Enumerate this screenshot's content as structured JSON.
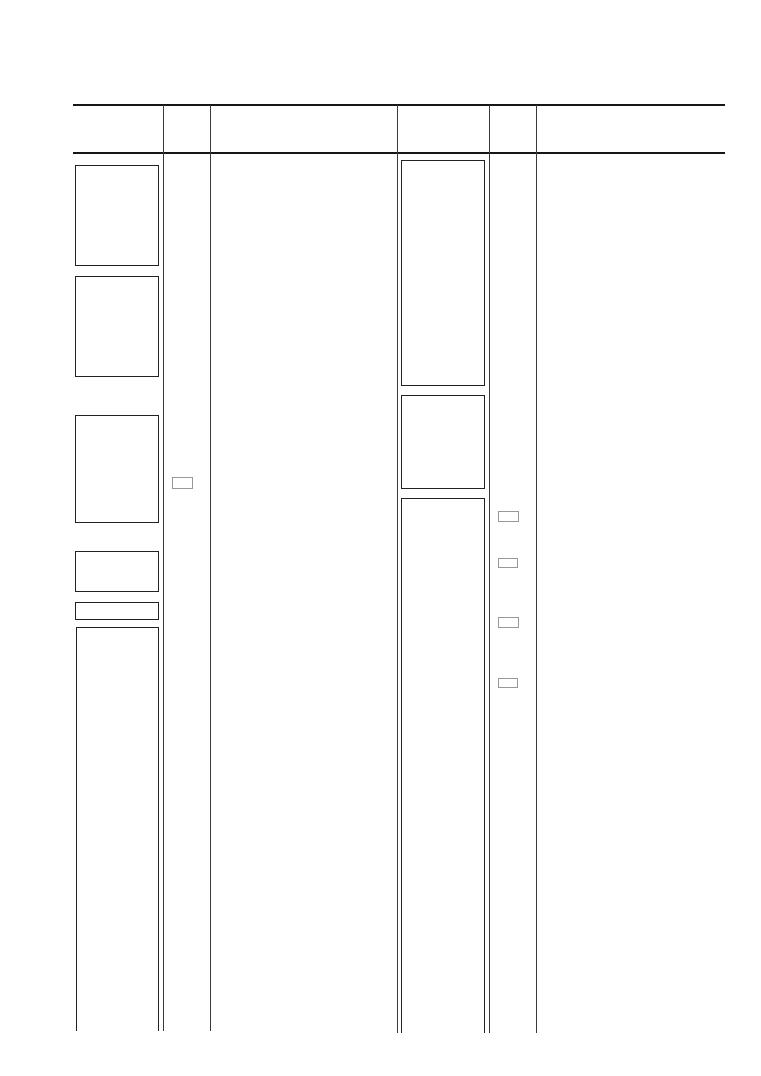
{
  "page": {
    "width": 761,
    "height": 1076,
    "background": "#ffffff",
    "visible_text": ""
  },
  "colors": {
    "header_rule": "#161616",
    "column_divider": "#3a3a3a",
    "box_border": "#222222",
    "placeholder_border": "#989898"
  },
  "table": {
    "header_rules": [
      {
        "name": "header-top-rule",
        "x": 73,
        "y": 104,
        "width": 652,
        "height": 2
      },
      {
        "name": "header-bottom-rule",
        "x": 73,
        "y": 152,
        "width": 652,
        "height": 2
      }
    ],
    "column_dividers": [
      {
        "name": "column-divider-1",
        "x": 163,
        "y": 105,
        "height": 926
      },
      {
        "name": "column-divider-2",
        "x": 210,
        "y": 105,
        "height": 926
      },
      {
        "name": "column-divider-3",
        "x": 397,
        "y": 105,
        "height": 928
      },
      {
        "name": "column-divider-4",
        "x": 489,
        "y": 105,
        "height": 928
      },
      {
        "name": "column-divider-5",
        "x": 536,
        "y": 105,
        "height": 928
      }
    ],
    "left_column_boxes": [
      {
        "name": "left-box-1",
        "x": 75,
        "y": 165,
        "width": 84,
        "height": 101,
        "open_bottom": false
      },
      {
        "name": "left-box-2",
        "x": 75,
        "y": 276,
        "width": 84,
        "height": 101,
        "open_bottom": false
      },
      {
        "name": "left-box-3",
        "x": 75,
        "y": 415,
        "width": 84,
        "height": 108,
        "open_bottom": false
      },
      {
        "name": "left-box-4",
        "x": 75,
        "y": 551,
        "width": 84,
        "height": 41,
        "open_bottom": false
      },
      {
        "name": "left-box-5",
        "x": 75,
        "y": 602,
        "width": 84,
        "height": 18,
        "open_bottom": false
      },
      {
        "name": "left-box-6",
        "x": 76,
        "y": 627,
        "width": 83,
        "height": 404,
        "open_bottom": true
      }
    ],
    "middle_column_boxes": [
      {
        "name": "middle-box-1",
        "x": 401,
        "y": 160,
        "width": 84,
        "height": 226,
        "open_bottom": false
      },
      {
        "name": "middle-box-2",
        "x": 401,
        "y": 395,
        "width": 84,
        "height": 94,
        "open_bottom": false
      },
      {
        "name": "middle-box-3",
        "x": 401,
        "y": 498,
        "width": 84,
        "height": 535,
        "open_bottom": true
      }
    ],
    "small_placeholders": [
      {
        "name": "mini-rect-1",
        "x": 172,
        "y": 477,
        "width": 21,
        "height": 12
      },
      {
        "name": "mini-rect-2",
        "x": 498,
        "y": 511,
        "width": 21,
        "height": 11
      },
      {
        "name": "mini-rect-3",
        "x": 498,
        "y": 558,
        "width": 20,
        "height": 10
      },
      {
        "name": "mini-rect-4",
        "x": 498,
        "y": 617,
        "width": 21,
        "height": 11
      },
      {
        "name": "mini-rect-5",
        "x": 498,
        "y": 678,
        "width": 20,
        "height": 10
      }
    ]
  }
}
